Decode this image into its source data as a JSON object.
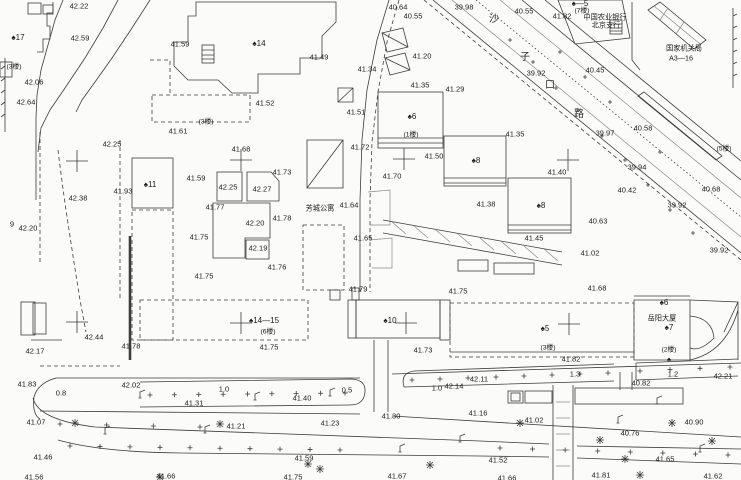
{
  "map_type": "cadastral-survey-site-plan",
  "colors": {
    "line": "#3c3c3c",
    "text": "#1a1a1a",
    "background": "#fbfbf9"
  },
  "groups": {
    "elevations": {
      "desc": "spot elevation values (meters)",
      "items": [
        {
          "t": "42.22",
          "x": 79,
          "y": 6
        },
        {
          "t": "42.59",
          "x": 80,
          "y": 38
        },
        {
          "t": "41.59",
          "x": 180,
          "y": 44
        },
        {
          "t": "42.06",
          "x": 34,
          "y": 82
        },
        {
          "t": "42.64",
          "x": 26,
          "y": 102
        },
        {
          "t": "41.61",
          "x": 178,
          "y": 131
        },
        {
          "t": "42.25",
          "x": 112,
          "y": 144
        },
        {
          "t": "41.68",
          "x": 241,
          "y": 149
        },
        {
          "t": "40.64",
          "x": 398,
          "y": 7
        },
        {
          "t": "40.55",
          "x": 413,
          "y": 16
        },
        {
          "t": "39.98",
          "x": 464,
          "y": 7
        },
        {
          "t": "40.55",
          "x": 524,
          "y": 11
        },
        {
          "t": "41.82",
          "x": 562,
          "y": 16
        },
        {
          "t": "39.92",
          "x": 536,
          "y": 73
        },
        {
          "t": "40.45",
          "x": 595,
          "y": 70
        },
        {
          "t": "41.49",
          "x": 319,
          "y": 57
        },
        {
          "t": "41.34",
          "x": 367,
          "y": 69
        },
        {
          "t": "41.20",
          "x": 422,
          "y": 56
        },
        {
          "t": "41.35",
          "x": 420,
          "y": 85
        },
        {
          "t": "41.29",
          "x": 455,
          "y": 89
        },
        {
          "t": "41.52",
          "x": 265,
          "y": 103
        },
        {
          "t": "41.51",
          "x": 356,
          "y": 112
        },
        {
          "t": "41.72",
          "x": 360,
          "y": 147
        },
        {
          "t": "41.50",
          "x": 434,
          "y": 156
        },
        {
          "t": "41.35",
          "x": 515,
          "y": 134
        },
        {
          "t": "39.97",
          "x": 605,
          "y": 133
        },
        {
          "t": "40.58",
          "x": 643,
          "y": 128
        },
        {
          "t": "39.94",
          "x": 637,
          "y": 167
        },
        {
          "t": "40.42",
          "x": 627,
          "y": 190
        },
        {
          "t": "39.92",
          "x": 677,
          "y": 205
        },
        {
          "t": "40.68",
          "x": 711,
          "y": 189
        },
        {
          "t": "40.63",
          "x": 598,
          "y": 221
        },
        {
          "t": "41.02",
          "x": 590,
          "y": 253
        },
        {
          "t": "39.92",
          "x": 719,
          "y": 250
        },
        {
          "t": "41.68",
          "x": 597,
          "y": 288
        },
        {
          "t": "42.38",
          "x": 78,
          "y": 198
        },
        {
          "t": "41.93",
          "x": 123,
          "y": 191
        },
        {
          "t": "41.59",
          "x": 196,
          "y": 178
        },
        {
          "t": "42.25",
          "x": 228,
          "y": 187
        },
        {
          "t": "42.27",
          "x": 262,
          "y": 189
        },
        {
          "t": "41.73",
          "x": 282,
          "y": 172
        },
        {
          "t": "41.77",
          "x": 215,
          "y": 207
        },
        {
          "t": "42.20",
          "x": 255,
          "y": 223
        },
        {
          "t": "41.78",
          "x": 282,
          "y": 218
        },
        {
          "t": "41.75",
          "x": 199,
          "y": 237
        },
        {
          "t": "42.19",
          "x": 258,
          "y": 248
        },
        {
          "t": "41.76",
          "x": 277,
          "y": 267
        },
        {
          "t": "41.75",
          "x": 204,
          "y": 276
        },
        {
          "t": "42.20",
          "x": 28,
          "y": 228
        },
        {
          "t": "9",
          "x": 12,
          "y": 224
        },
        {
          "t": "41.64",
          "x": 349,
          "y": 205
        },
        {
          "t": "41.65",
          "x": 363,
          "y": 238
        },
        {
          "t": "41.70",
          "x": 392,
          "y": 176
        },
        {
          "t": "41.38",
          "x": 486,
          "y": 204
        },
        {
          "t": "41.40",
          "x": 557,
          "y": 172
        },
        {
          "t": "41.45",
          "x": 534,
          "y": 238
        },
        {
          "t": "42.44",
          "x": 94,
          "y": 337
        },
        {
          "t": "42.17",
          "x": 35,
          "y": 351
        },
        {
          "t": "41.78",
          "x": 131,
          "y": 346
        },
        {
          "t": "41.83",
          "x": 27,
          "y": 384
        },
        {
          "t": "42.02",
          "x": 131,
          "y": 385
        },
        {
          "t": "41.31",
          "x": 194,
          "y": 403
        },
        {
          "t": "41.79",
          "x": 358,
          "y": 289
        },
        {
          "t": "41.75",
          "x": 458,
          "y": 291
        },
        {
          "t": "41.75",
          "x": 269,
          "y": 347
        },
        {
          "t": "41.73",
          "x": 423,
          "y": 350
        },
        {
          "t": "41.40",
          "x": 302,
          "y": 398
        },
        {
          "t": "42.14",
          "x": 454,
          "y": 386
        },
        {
          "t": "42.11",
          "x": 479,
          "y": 379
        },
        {
          "t": "41.82",
          "x": 571,
          "y": 359
        },
        {
          "t": "42.21",
          "x": 723,
          "y": 376
        },
        {
          "t": "40.82",
          "x": 641,
          "y": 383
        },
        {
          "t": "41.07",
          "x": 36,
          "y": 422
        },
        {
          "t": "41.21",
          "x": 236,
          "y": 426
        },
        {
          "t": "41.46",
          "x": 43,
          "y": 457
        },
        {
          "t": "41.56",
          "x": 34,
          "y": 477
        },
        {
          "t": "41.66",
          "x": 166,
          "y": 476
        },
        {
          "t": "41.23",
          "x": 330,
          "y": 423
        },
        {
          "t": "41.30",
          "x": 391,
          "y": 416
        },
        {
          "t": "41.16",
          "x": 478,
          "y": 413
        },
        {
          "t": "41.59",
          "x": 304,
          "y": 458
        },
        {
          "t": "41.75",
          "x": 293,
          "y": 477
        },
        {
          "t": "41.67",
          "x": 397,
          "y": 476
        },
        {
          "t": "41.02",
          "x": 534,
          "y": 420
        },
        {
          "t": "40.90",
          "x": 694,
          "y": 422
        },
        {
          "t": "40.76",
          "x": 630,
          "y": 433
        },
        {
          "t": "41.52",
          "x": 498,
          "y": 460
        },
        {
          "t": "41.65",
          "x": 665,
          "y": 459
        },
        {
          "t": "41.81",
          "x": 601,
          "y": 475
        },
        {
          "t": "41.62",
          "x": 713,
          "y": 476
        },
        {
          "t": "41.66",
          "x": 507,
          "y": 478
        }
      ]
    },
    "buildings": {
      "desc": "building number labels",
      "items": [
        {
          "t": "♠17",
          "x": 18,
          "y": 38
        },
        {
          "t": "♠14",
          "x": 259,
          "y": 44
        },
        {
          "t": "♠—5",
          "x": 580,
          "y": 4
        },
        {
          "t": "♠6",
          "x": 412,
          "y": 117
        },
        {
          "t": "♠8",
          "x": 476,
          "y": 161
        },
        {
          "t": "♠8",
          "x": 541,
          "y": 206
        },
        {
          "t": "♠11",
          "x": 150,
          "y": 185
        },
        {
          "t": "♠14—15",
          "x": 264,
          "y": 321
        },
        {
          "t": "♠10",
          "x": 390,
          "y": 321
        },
        {
          "t": "♠5",
          "x": 545,
          "y": 329
        },
        {
          "t": "♠6",
          "x": 664,
          "y": 303
        },
        {
          "t": "♠7",
          "x": 669,
          "y": 328
        },
        {
          "t": "♠",
          "x": 669,
          "y": 360
        }
      ]
    },
    "floors": {
      "desc": "storey-count notes",
      "items": [
        {
          "t": "(3楼)",
          "x": 14,
          "y": 68
        },
        {
          "t": "(3楼)",
          "x": 206,
          "y": 123
        },
        {
          "t": "(7楼)",
          "x": 582,
          "y": 12
        },
        {
          "t": "(1楼)",
          "x": 411,
          "y": 136
        },
        {
          "t": "(5楼)",
          "x": 724,
          "y": 150
        },
        {
          "t": "(6楼)",
          "x": 268,
          "y": 333
        },
        {
          "t": "(3楼)",
          "x": 548,
          "y": 349
        },
        {
          "t": "(2楼)",
          "x": 669,
          "y": 351
        }
      ]
    },
    "names": {
      "desc": "place / institution names",
      "items": [
        {
          "t": "中国农业银行",
          "x": 605,
          "y": 17
        },
        {
          "t": "北京支行",
          "x": 606,
          "y": 25
        },
        {
          "t": "国家机关局",
          "x": 684,
          "y": 48
        },
        {
          "t": "A3—16",
          "x": 681,
          "y": 58
        },
        {
          "t": "芳城公寓",
          "x": 320,
          "y": 208
        },
        {
          "t": "岳阳大厦",
          "x": 662,
          "y": 318
        }
      ]
    },
    "road_chars": {
      "desc": "road name characters along diagonal road",
      "items": [
        {
          "t": "沙",
          "x": 494,
          "y": 20
        },
        {
          "t": "子",
          "x": 525,
          "y": 58
        },
        {
          "t": "口",
          "x": 550,
          "y": 86
        },
        {
          "t": "路",
          "x": 579,
          "y": 115
        }
      ]
    },
    "dims": {
      "desc": "width/dimension annotations",
      "items": [
        {
          "t": "0.8",
          "x": 61,
          "y": 393
        },
        {
          "t": "1.0",
          "x": 224,
          "y": 389
        },
        {
          "t": "0.5",
          "x": 347,
          "y": 390
        },
        {
          "t": "1.0",
          "x": 437,
          "y": 388
        },
        {
          "t": "1.3",
          "x": 575,
          "y": 374
        },
        {
          "t": "1.2",
          "x": 673,
          "y": 374
        }
      ]
    }
  },
  "symbols": {
    "survey_crosses": [
      [
        77,
        161
      ],
      [
        241,
        160
      ],
      [
        404,
        159
      ],
      [
        568,
        160
      ],
      [
        77,
        322
      ],
      [
        241,
        323
      ],
      [
        406,
        323
      ],
      [
        569,
        324
      ]
    ],
    "trees": [
      [
        75,
        423
      ],
      [
        220,
        424
      ],
      [
        160,
        477
      ],
      [
        308,
        464
      ],
      [
        520,
        423
      ],
      [
        600,
        440
      ],
      [
        640,
        475
      ],
      [
        672,
        423
      ],
      [
        712,
        441
      ],
      [
        625,
        459
      ],
      [
        320,
        469
      ],
      [
        430,
        465
      ]
    ],
    "lamps": [
      [
        105,
        434
      ],
      [
        205,
        433
      ],
      [
        255,
        400
      ],
      [
        330,
        396
      ],
      [
        400,
        452
      ],
      [
        460,
        442
      ],
      [
        657,
        404
      ],
      [
        700,
        452
      ],
      [
        618,
        423
      ],
      [
        140,
        398
      ]
    ],
    "plus_rows": [
      {
        "x1": 150,
        "y1": 395,
        "x2": 345,
        "y2": 393,
        "n": 9
      },
      {
        "x1": 412,
        "y1": 380,
        "x2": 608,
        "y2": 373,
        "n": 8
      },
      {
        "x1": 640,
        "y1": 371,
        "x2": 730,
        "y2": 367,
        "n": 4
      },
      {
        "x1": 70,
        "y1": 446,
        "x2": 340,
        "y2": 450,
        "n": 10
      },
      {
        "x1": 500,
        "y1": 448,
        "x2": 728,
        "y2": 455,
        "n": 8
      },
      {
        "x1": 60,
        "y1": 424,
        "x2": 200,
        "y2": 427,
        "n": 4
      }
    ],
    "road_ticks": [
      [
        510,
        40
      ],
      [
        533,
        62
      ],
      [
        556,
        88
      ],
      [
        578,
        110
      ],
      [
        602,
        136
      ],
      [
        625,
        160
      ],
      [
        648,
        185
      ],
      [
        670,
        210
      ],
      [
        693,
        233
      ],
      [
        560,
        52
      ],
      [
        585,
        77
      ],
      [
        610,
        102
      ],
      [
        660,
        152
      ]
    ]
  }
}
